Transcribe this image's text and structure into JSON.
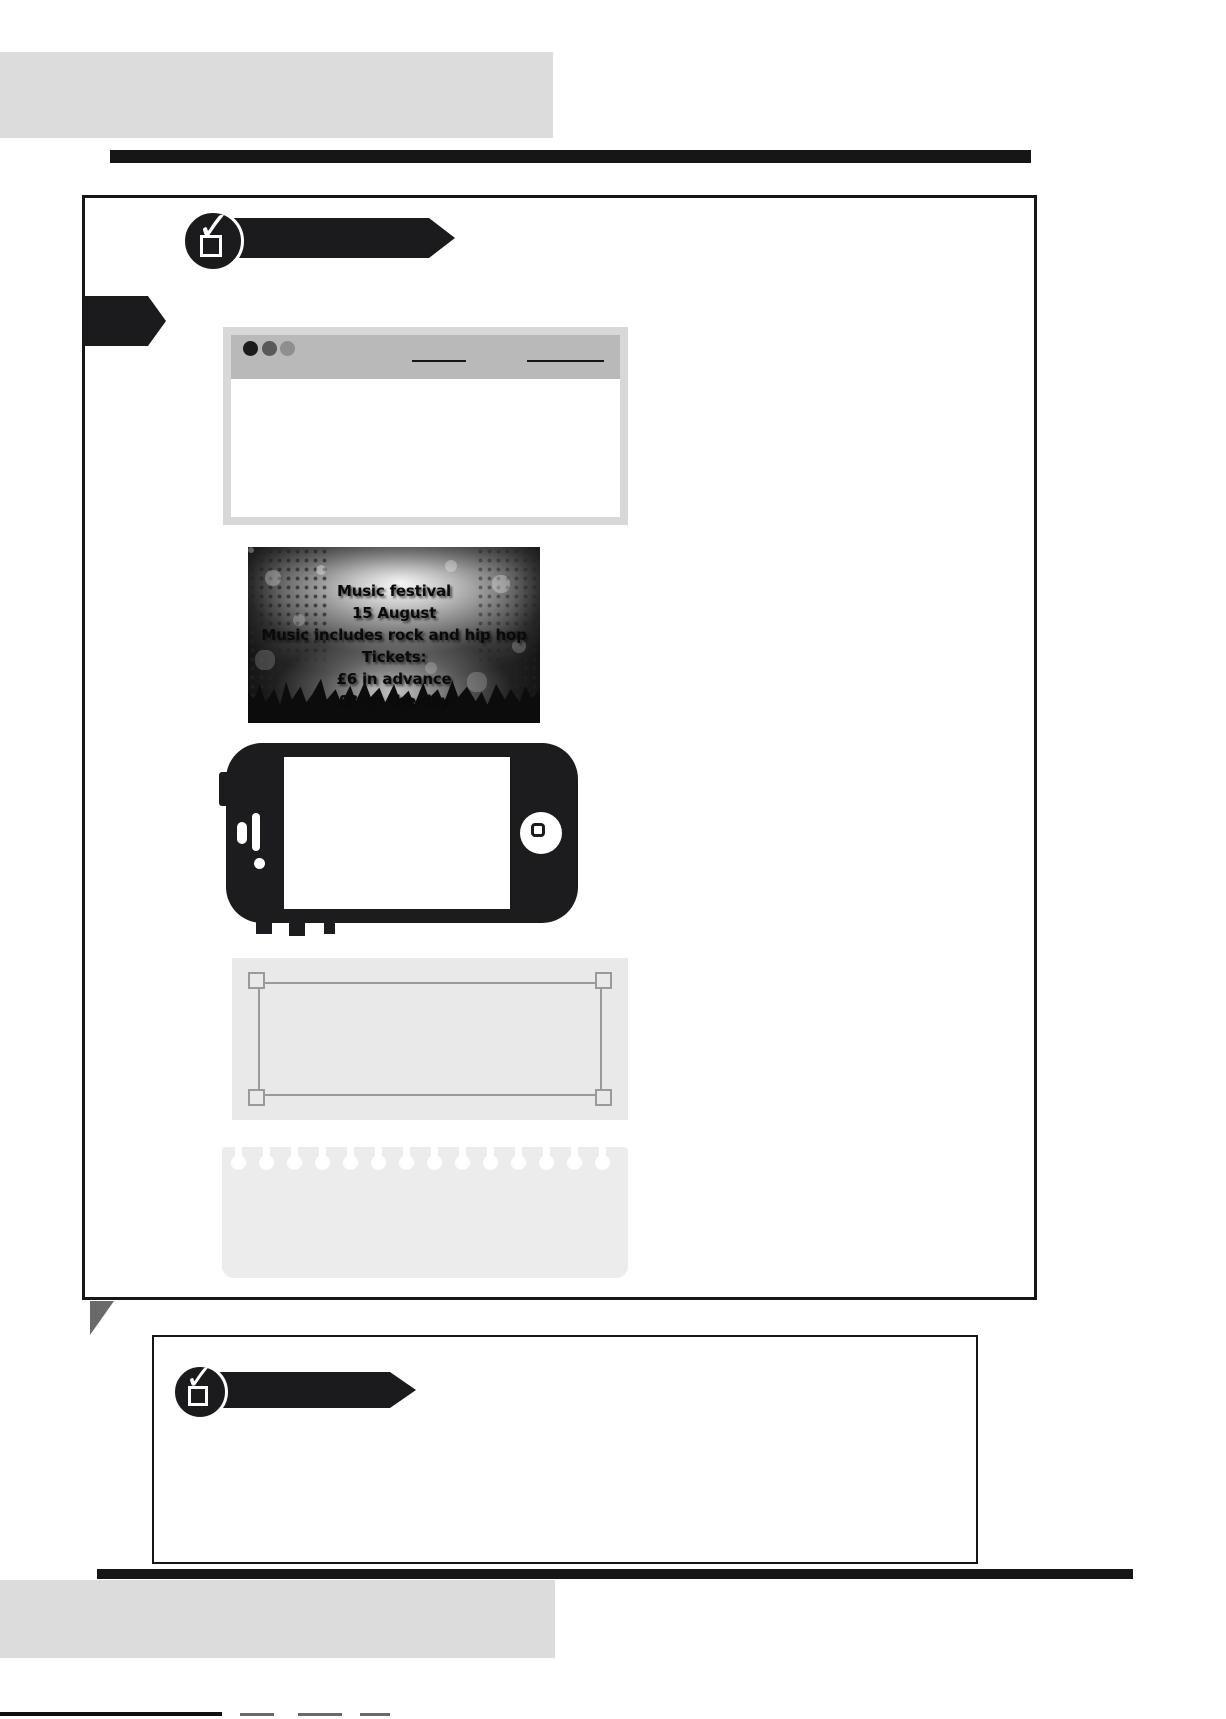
{
  "page": {
    "width": 1226,
    "height": 1719,
    "background": "#ffffff",
    "description": "Scanned textbook worksheet page with blank checklist banners and illustration placeholders"
  },
  "colors": {
    "ink": "#161616",
    "banner_black": "#1b1b1d",
    "gray_block": "#dcdcdc",
    "browser_frame": "#d8d8d8",
    "browser_header": "#b9b9b9",
    "browser_dot_dark": "#1c1c1c",
    "browser_dot_medium": "#595959",
    "browser_dot_light": "#8f8f8f",
    "panel_bg": "#e9e9e9",
    "panel_border": "#9a9a9a",
    "notebook_bg": "#ececec",
    "fold_shadow": "#6a6a6a"
  },
  "icons": {
    "checkmark": "✓",
    "checkbox": "ballot-box-with-check",
    "browser_dots": [
      "window-dot-dark",
      "window-dot-medium",
      "window-dot-light"
    ]
  },
  "poster": {
    "lines": [
      "Music festival",
      "15 August",
      "Music includes rock and hip hop",
      "Tickets:",
      "£6 in advance",
      "£8 on the day"
    ]
  }
}
